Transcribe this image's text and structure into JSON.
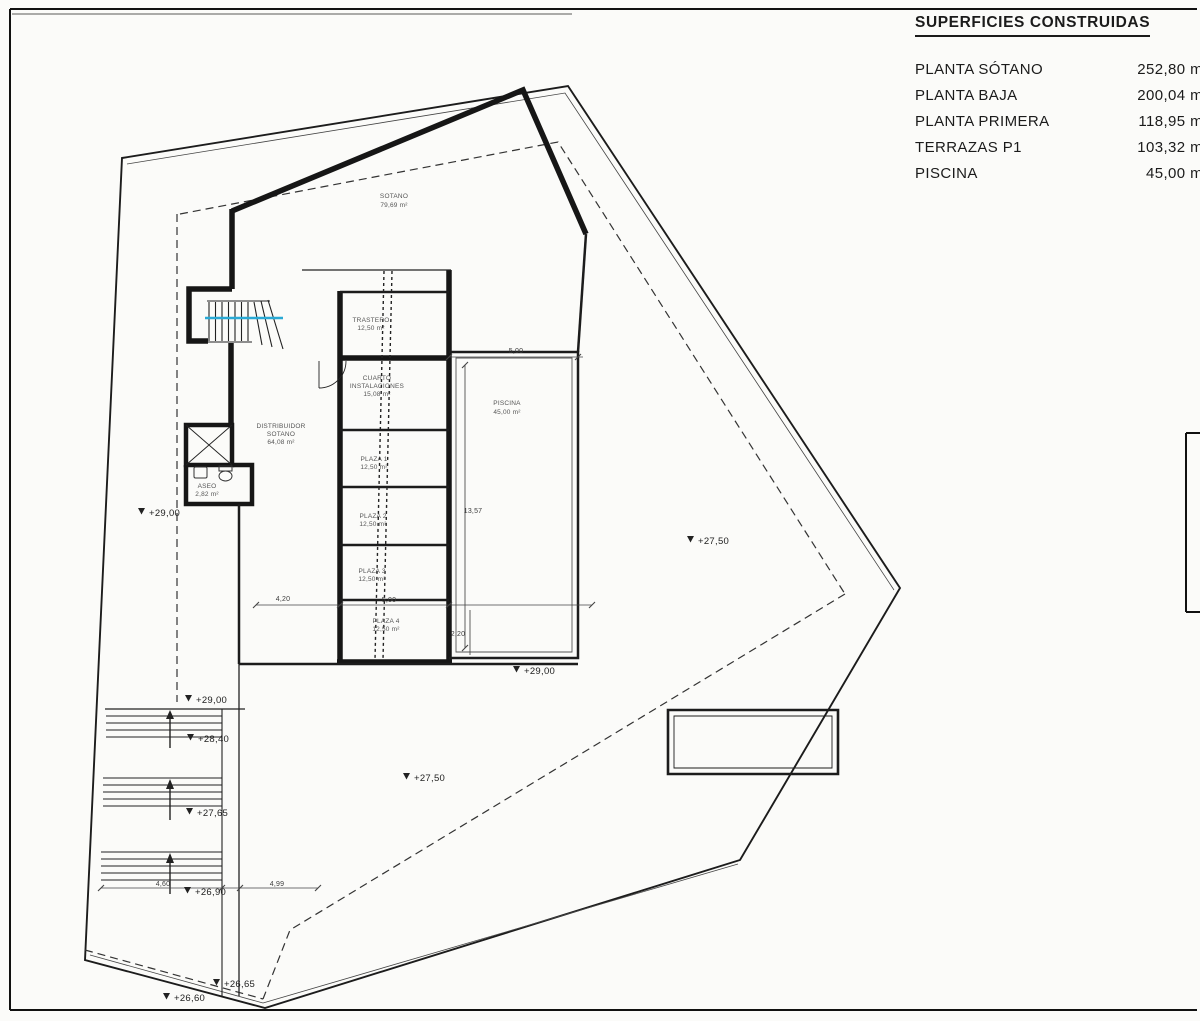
{
  "colors": {
    "line": "#1c1c1c",
    "accent_cyan": "#2aa9d4",
    "text": "#1b1b1b"
  },
  "legend": {
    "title": "SUPERFICIES CONSTRUIDAS",
    "rows": [
      {
        "label": "PLANTA SÓTANO",
        "value": "252,80 m"
      },
      {
        "label": "PLANTA BAJA",
        "value": "200,04 m"
      },
      {
        "label": "PLANTA PRIMERA",
        "value": "118,95 m"
      },
      {
        "label": "TERRAZAS P1",
        "value": "103,32 m"
      },
      {
        "label": "PISCINA",
        "value": "45,00 m"
      }
    ]
  },
  "plan": {
    "rooms": {
      "sotano": {
        "line1": "SOTANO",
        "area": "79,69 m²"
      },
      "trastero": {
        "line1": "TRASTERO",
        "area": "12,50 m²"
      },
      "cuarto": {
        "line1": "CUARTO",
        "line2": "INSTALACIONES",
        "area": "15,08 m²"
      },
      "distribuidor": {
        "line1": "DISTRIBUIDOR",
        "line2": "SOTANO",
        "area": "64,08 m²"
      },
      "aseo": {
        "line1": "ASEO",
        "area": "2,82 m²"
      },
      "piscina": {
        "line1": "PISCINA",
        "area": "45,00 m²"
      },
      "plaza1": {
        "line1": "PLAZA 1",
        "area": "12,50 m²"
      },
      "plaza2": {
        "line1": "PLAZA 2",
        "area": "12,50 m²"
      },
      "plaza3": {
        "line1": "PLAZA 3",
        "area": "12,50 m²"
      },
      "plaza4": {
        "line1": "PLAZA 4",
        "area": "12,50 m²"
      }
    },
    "levels": {
      "left": "+29,00",
      "right": "+27,50",
      "pool": "+29,00",
      "stair_top": "+29,00",
      "stair_mid": "+28,40",
      "terrace": "+27,50",
      "stair_low": "+27,65",
      "stair_bottom": "+26,90",
      "bottom_a": "+26,65",
      "bottom_b": "+26,60"
    },
    "dims": {
      "pool_top": "5,00",
      "pool_side": "13,57",
      "garage_bottom_left": "4,20",
      "garage_bottom": "5,00",
      "corner": "2,20",
      "stairs_width": "4,60",
      "terrace_width": "4,99"
    }
  }
}
